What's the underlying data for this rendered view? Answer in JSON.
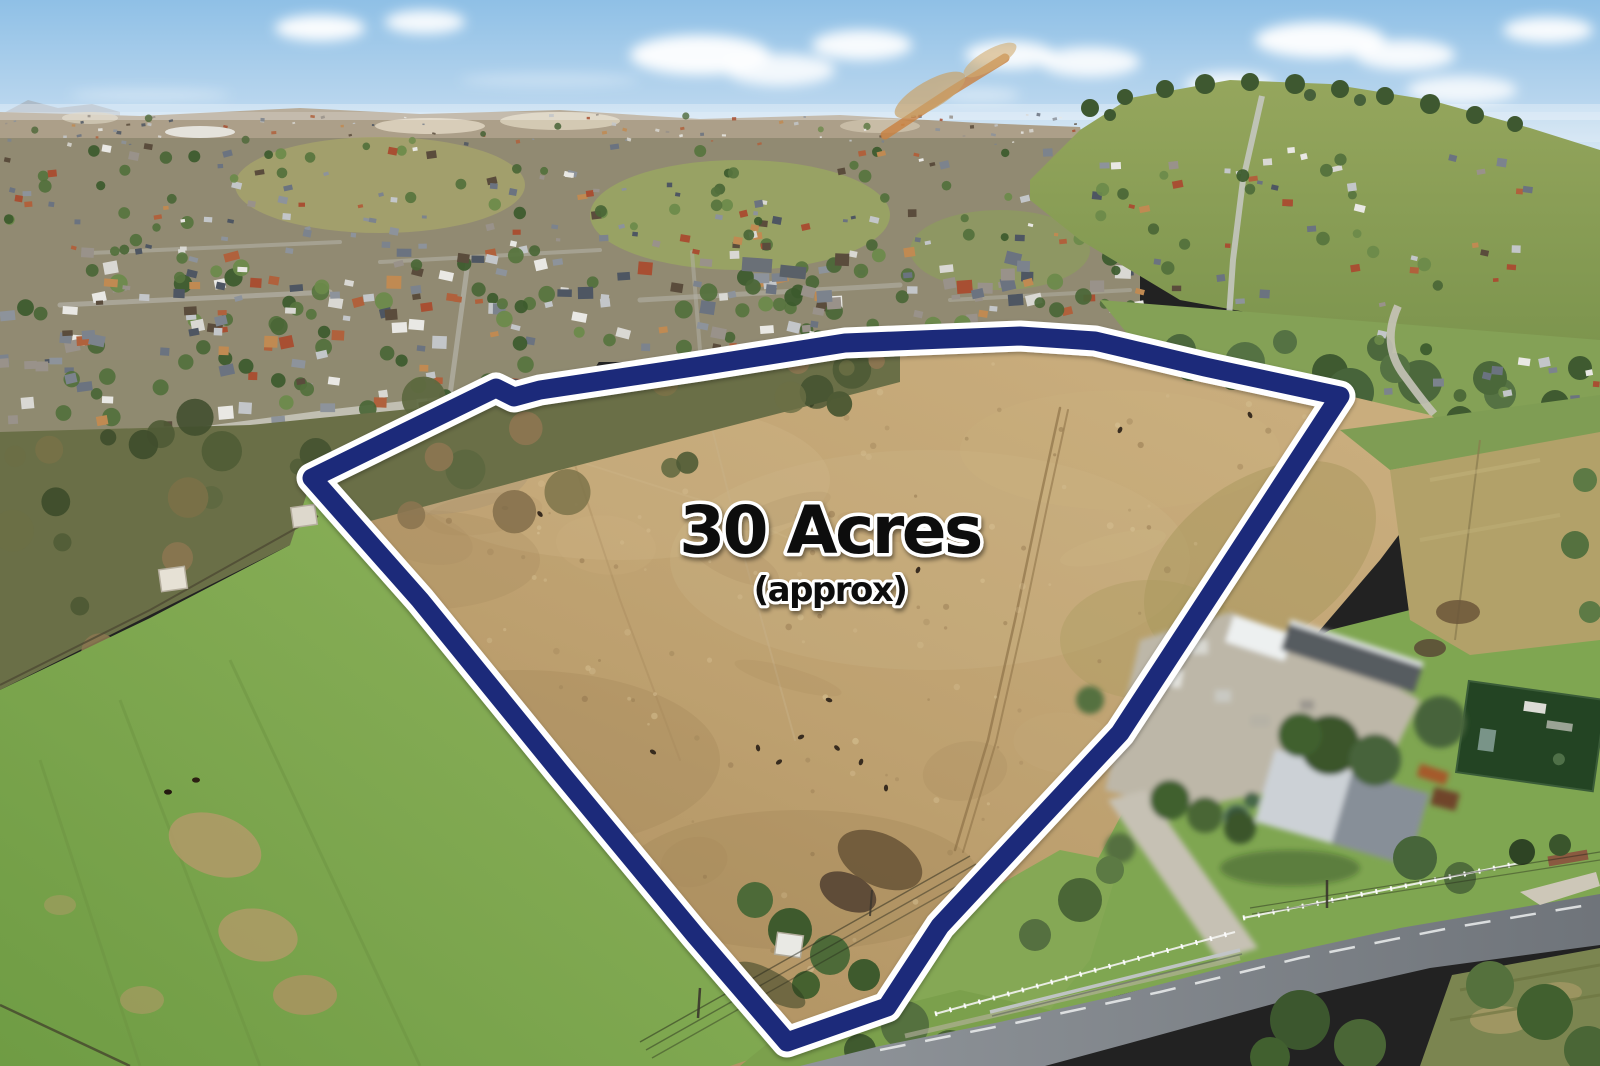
{
  "photo": {
    "description": "aerial-drone-photo-of-rural-property-for-sale",
    "scene_tags": [
      "suburb-in-distance",
      "dry-paddock",
      "green-pasture",
      "farm-shed-complex",
      "country-road"
    ]
  },
  "overlay": {
    "area_label": "30 Acres",
    "area_sublabel": "(approx)"
  },
  "colors": {
    "boundary_navy": "#1b2b7a",
    "boundary_outline": "#ffffff",
    "label_fill": "#101010",
    "label_stroke": "#ffffff",
    "sky_top": "#8fc0e6",
    "sky_horizon": "#dcebf5",
    "paddock_tan": "#bda06f",
    "field_green": "#7fa74e",
    "road_gray": "#83888d"
  },
  "boundary": {
    "points": "312,478 496,388 514,397 540,390 700,366 845,343 1020,336 1095,341 1205,367 1340,396 1120,733 940,926 887,1007 787,1042 695,935 560,772 420,600",
    "stroke_width_outer": 31,
    "stroke_width_inner": 19
  },
  "scene": {
    "house_palette": [
      "#4e5662",
      "#6b7380",
      "#8d939b",
      "#c3c6c9",
      "#e9e8e4",
      "#b0613c",
      "#c08a52",
      "#5a4c3c",
      "#99928a",
      "#7c838d",
      "#d9d8d3",
      "#a84f32"
    ],
    "tree_palette": [
      "#4a6636",
      "#57743e",
      "#3c5a2d",
      "#6b8a4a",
      "#52703c"
    ],
    "scrub_palette": [
      "#4e5a35",
      "#5d6840",
      "#7a7147",
      "#8a7550",
      "#3f4d2c",
      "#6b6f45"
    ],
    "spray": [
      {
        "layer": "g-distant",
        "x0": 0,
        "y0": 114,
        "x1": 1080,
        "y1": 145,
        "count": 95,
        "tree": 0.15,
        "min": 2,
        "max": 5
      },
      {
        "layer": "g-suburb-houses",
        "x0": 0,
        "y0": 146,
        "x1": 1140,
        "y1": 252,
        "count": 175,
        "tree": 0.3,
        "min": 4,
        "max": 10
      },
      {
        "layer": "g-suburb-houses",
        "x0": 0,
        "y0": 252,
        "x1": 1140,
        "y1": 348,
        "count": 235,
        "tree": 0.3,
        "min": 7,
        "max": 16
      },
      {
        "layer": "g-suburb-houses",
        "x0": 0,
        "y0": 348,
        "x1": 590,
        "y1": 428,
        "count": 70,
        "tree": 0.33,
        "min": 8,
        "max": 16
      },
      {
        "layer": "g-hill-houses",
        "x0": 1090,
        "y0": 150,
        "x1": 1530,
        "y1": 305,
        "count": 62,
        "tree": 0.38,
        "min": 5,
        "max": 11
      },
      {
        "layer": "g-valley-houses",
        "x0": 1370,
        "y0": 332,
        "x1": 1600,
        "y1": 400,
        "count": 16,
        "tree": 0.3,
        "min": 6,
        "max": 12
      }
    ],
    "scrub": {
      "count": 40
    },
    "speckles": {
      "count": 235,
      "patches": 24
    },
    "cattle": [
      [
        365,
        486
      ],
      [
        393,
        497
      ],
      [
        352,
        470
      ],
      [
        417,
        500
      ],
      [
        505,
        508
      ],
      [
        540,
        514
      ],
      [
        745,
        415
      ],
      [
        706,
        428
      ],
      [
        812,
        404
      ],
      [
        758,
        748
      ],
      [
        779,
        762
      ],
      [
        801,
        737
      ],
      [
        837,
        748
      ],
      [
        861,
        762
      ],
      [
        829,
        700
      ],
      [
        653,
        752
      ],
      [
        886,
        788
      ],
      [
        918,
        570
      ],
      [
        1225,
        380
      ],
      [
        1250,
        415
      ],
      [
        1120,
        430
      ]
    ]
  }
}
